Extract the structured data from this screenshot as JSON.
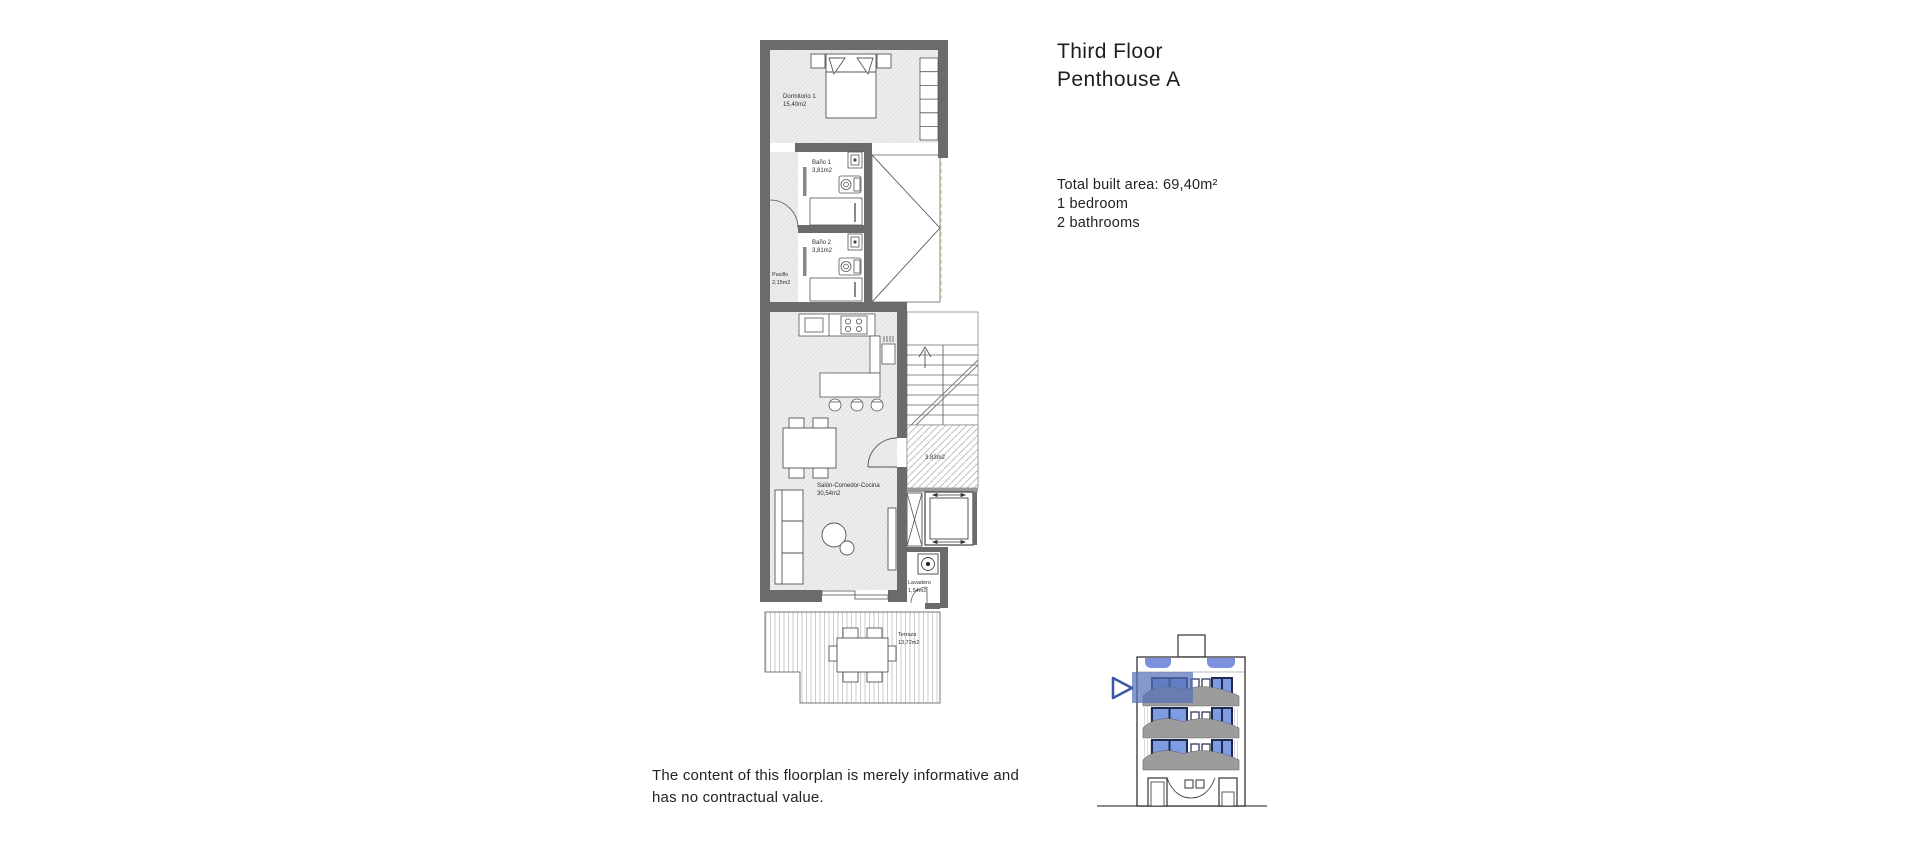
{
  "page": {
    "background": "#ffffff"
  },
  "header": {
    "title_line1": "Third Floor",
    "title_line2": "Penthouse A"
  },
  "summary": {
    "line1": "Total built area: 69,40m²",
    "line2": "1 bedroom",
    "line3": "2 bathrooms"
  },
  "disclaimer": {
    "line1": "The content of this floorplan is merely informative and",
    "line2": "has no contractual value."
  },
  "plan": {
    "rooms": {
      "bedroom": {
        "name": "Dormitorio 1",
        "area": "15,40m2"
      },
      "bath1": {
        "name": "Baño 1",
        "area": "3,81m2"
      },
      "bath2": {
        "name": "Baño 2",
        "area": "3,81m2"
      },
      "hallway": {
        "name": "Pasillo",
        "area": "2,15m2"
      },
      "living": {
        "name": "Salón-Comedor-Cocina",
        "area": "30,54m2"
      },
      "landing": {
        "area": "3,83m2"
      },
      "laundry": {
        "name": "Lavadero",
        "area": "1,54m2"
      },
      "terrace": {
        "name": "Terraza",
        "area": "13,72m2"
      }
    },
    "colors": {
      "wall": "#6b6b6b",
      "floor_fill": "#ececec",
      "boundary_dash": "#ccd59f"
    }
  },
  "elevation": {
    "colors": {
      "highlight_fill": "#5871b9b8",
      "marker_stroke": "#3c55a5",
      "window_glass": "#7e9ce2",
      "window_frame": "#1e2a52",
      "awning": "#7b91de",
      "balcony": "#9c9c9c"
    }
  }
}
